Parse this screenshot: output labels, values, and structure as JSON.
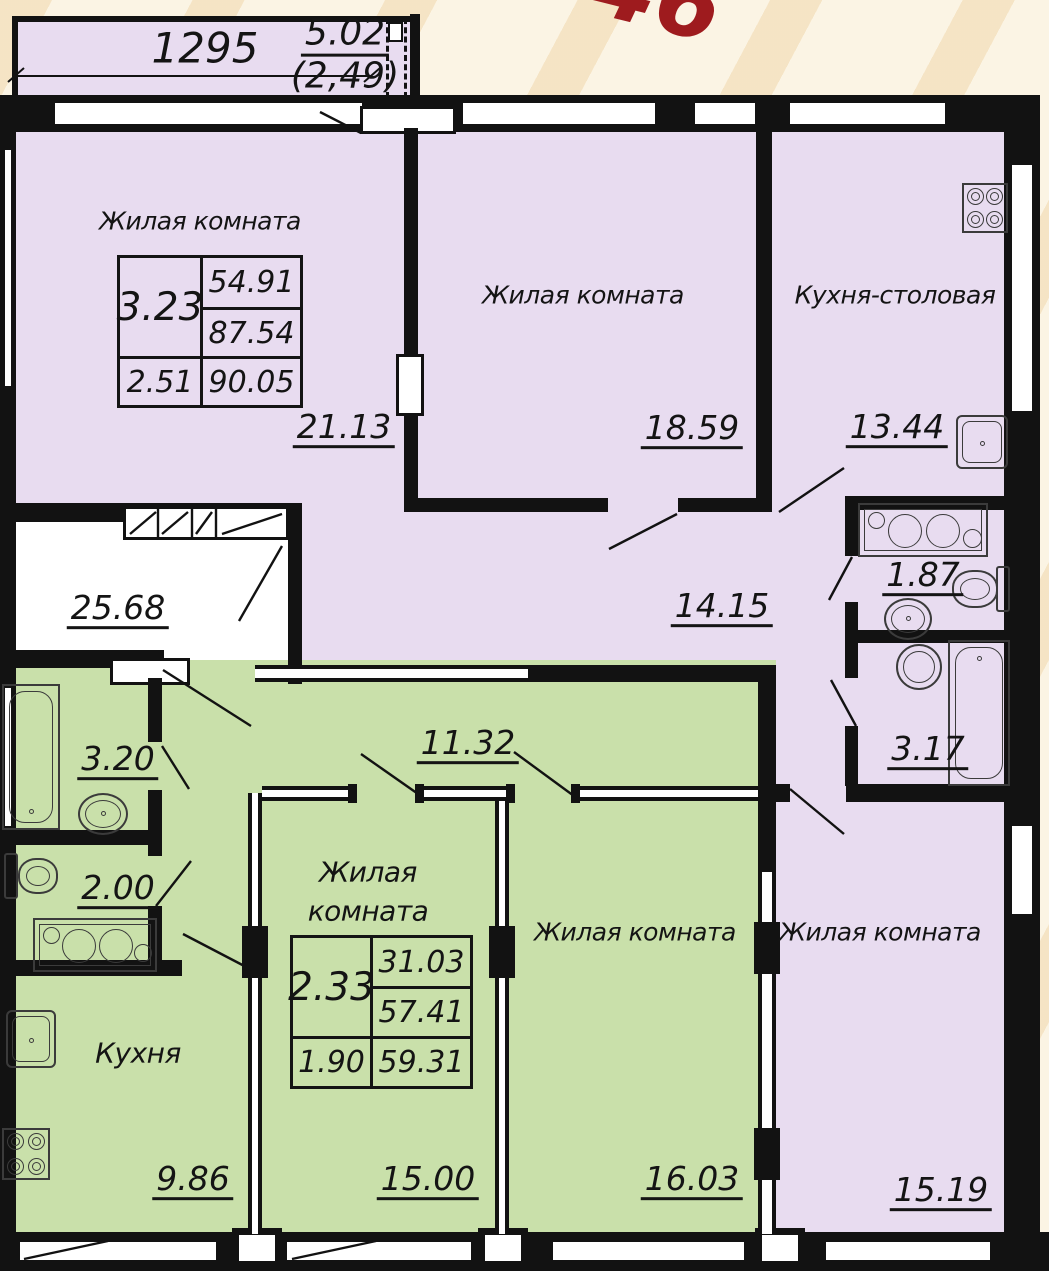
{
  "watermark": {
    "fragment": "46",
    "color": "#9e1b1e"
  },
  "colors": {
    "apartment_a_floor": "#e8dcf0",
    "apartment_b_floor": "#c9e0aa",
    "walls": "#121212",
    "background": "#fbf4e4"
  },
  "balcony": {
    "width_dim": "1295",
    "area": "5.02",
    "area_secondary": "(2,49)"
  },
  "common_area": {
    "corridor_area": "25.68"
  },
  "apartment_a": {
    "summary": {
      "coef": "3.23",
      "living_area": "54.91",
      "total_area": "87.54",
      "coef2": "2.51",
      "total_with_balcony": "90.05"
    },
    "living_room_1": {
      "name": "Жилая комната",
      "area": "21.13"
    },
    "living_room_2": {
      "name": "Жилая комната",
      "area": "18.59"
    },
    "kitchen_dining": {
      "name": "Кухня-столовая",
      "area": "13.44"
    },
    "hall": {
      "area": "14.15"
    },
    "wc": {
      "area": "1.87"
    },
    "bathroom": {
      "area": "3.17"
    },
    "living_room_3": {
      "name": "Жилая комната",
      "area": "15.19"
    }
  },
  "apartment_b": {
    "summary": {
      "coef": "2.33",
      "living_area": "31.03",
      "total_area": "57.41",
      "coef2": "1.90",
      "total_with_balcony": "59.31"
    },
    "bathroom": {
      "area": "3.20"
    },
    "wc": {
      "area": "2.00"
    },
    "hall": {
      "area": "11.32"
    },
    "kitchen": {
      "name": "Кухня",
      "area": "9.86"
    },
    "living_room_1": {
      "name_line1": "Жилая",
      "name_line2": "комната",
      "area": "15.00"
    },
    "living_room_2": {
      "name": "Жилая комната",
      "area": "16.03"
    }
  }
}
